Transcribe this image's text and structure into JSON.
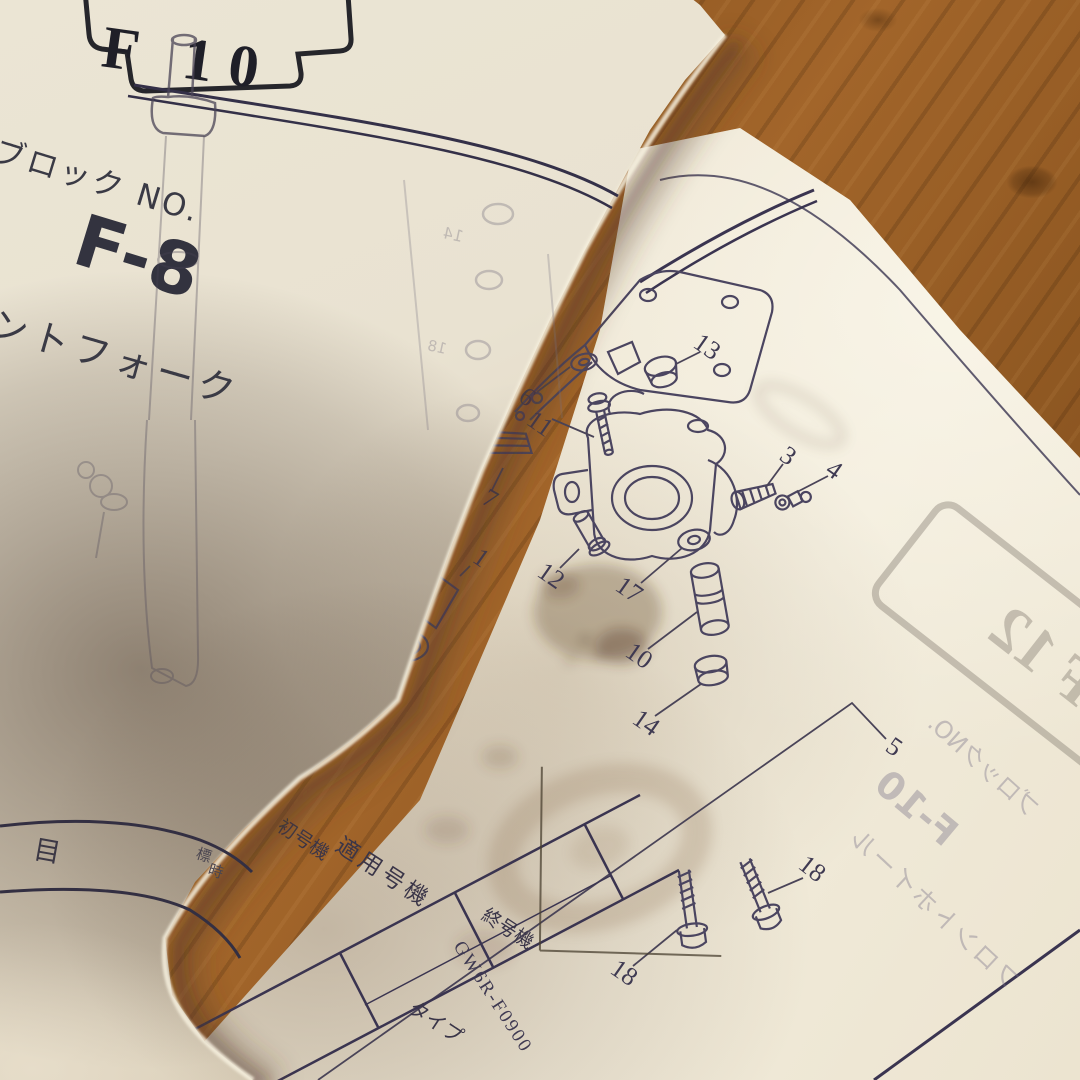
{
  "colors": {
    "wood": "#8f5620",
    "wood_dark": "#6e4015",
    "paper_lit": "#f0e9d7",
    "paper_shadow": "#9c8770",
    "ink": "#3a3450",
    "ink_dark": "#2a2733",
    "stain": "#6e4f33"
  },
  "turning_page": {
    "tab_label": "F 10",
    "block_no_label": "ブロック NO.",
    "block_no_value": "F-8",
    "section_title_partial": "ントフォーク",
    "table_item_header": "目",
    "table_note_char_1": "標",
    "table_note_char_2": "時",
    "ghost_label_1": "14",
    "ghost_label_2": "18"
  },
  "right_page": {
    "figure_code": "GW6R-F0900",
    "table_header_applicable": "適用号機",
    "table_header_first": "初号機",
    "table_header_last": "終号機",
    "table_header_type": "タイプ",
    "ghost_tab_label": "F 12",
    "ghost_block_no_label": "ブロックNO.",
    "ghost_block_no_value": "F-10",
    "ghost_section_title": "フロントホイール"
  },
  "diagram": {
    "callouts": [
      {
        "n": "13"
      },
      {
        "n": "6"
      },
      {
        "n": "11"
      },
      {
        "n": "7"
      },
      {
        "n": "1"
      },
      {
        "n": "12"
      },
      {
        "n": "17"
      },
      {
        "n": "3"
      },
      {
        "n": "4"
      },
      {
        "n": "10"
      },
      {
        "n": "14"
      },
      {
        "n": "5"
      },
      {
        "n": "18"
      },
      {
        "n": "18"
      }
    ]
  }
}
